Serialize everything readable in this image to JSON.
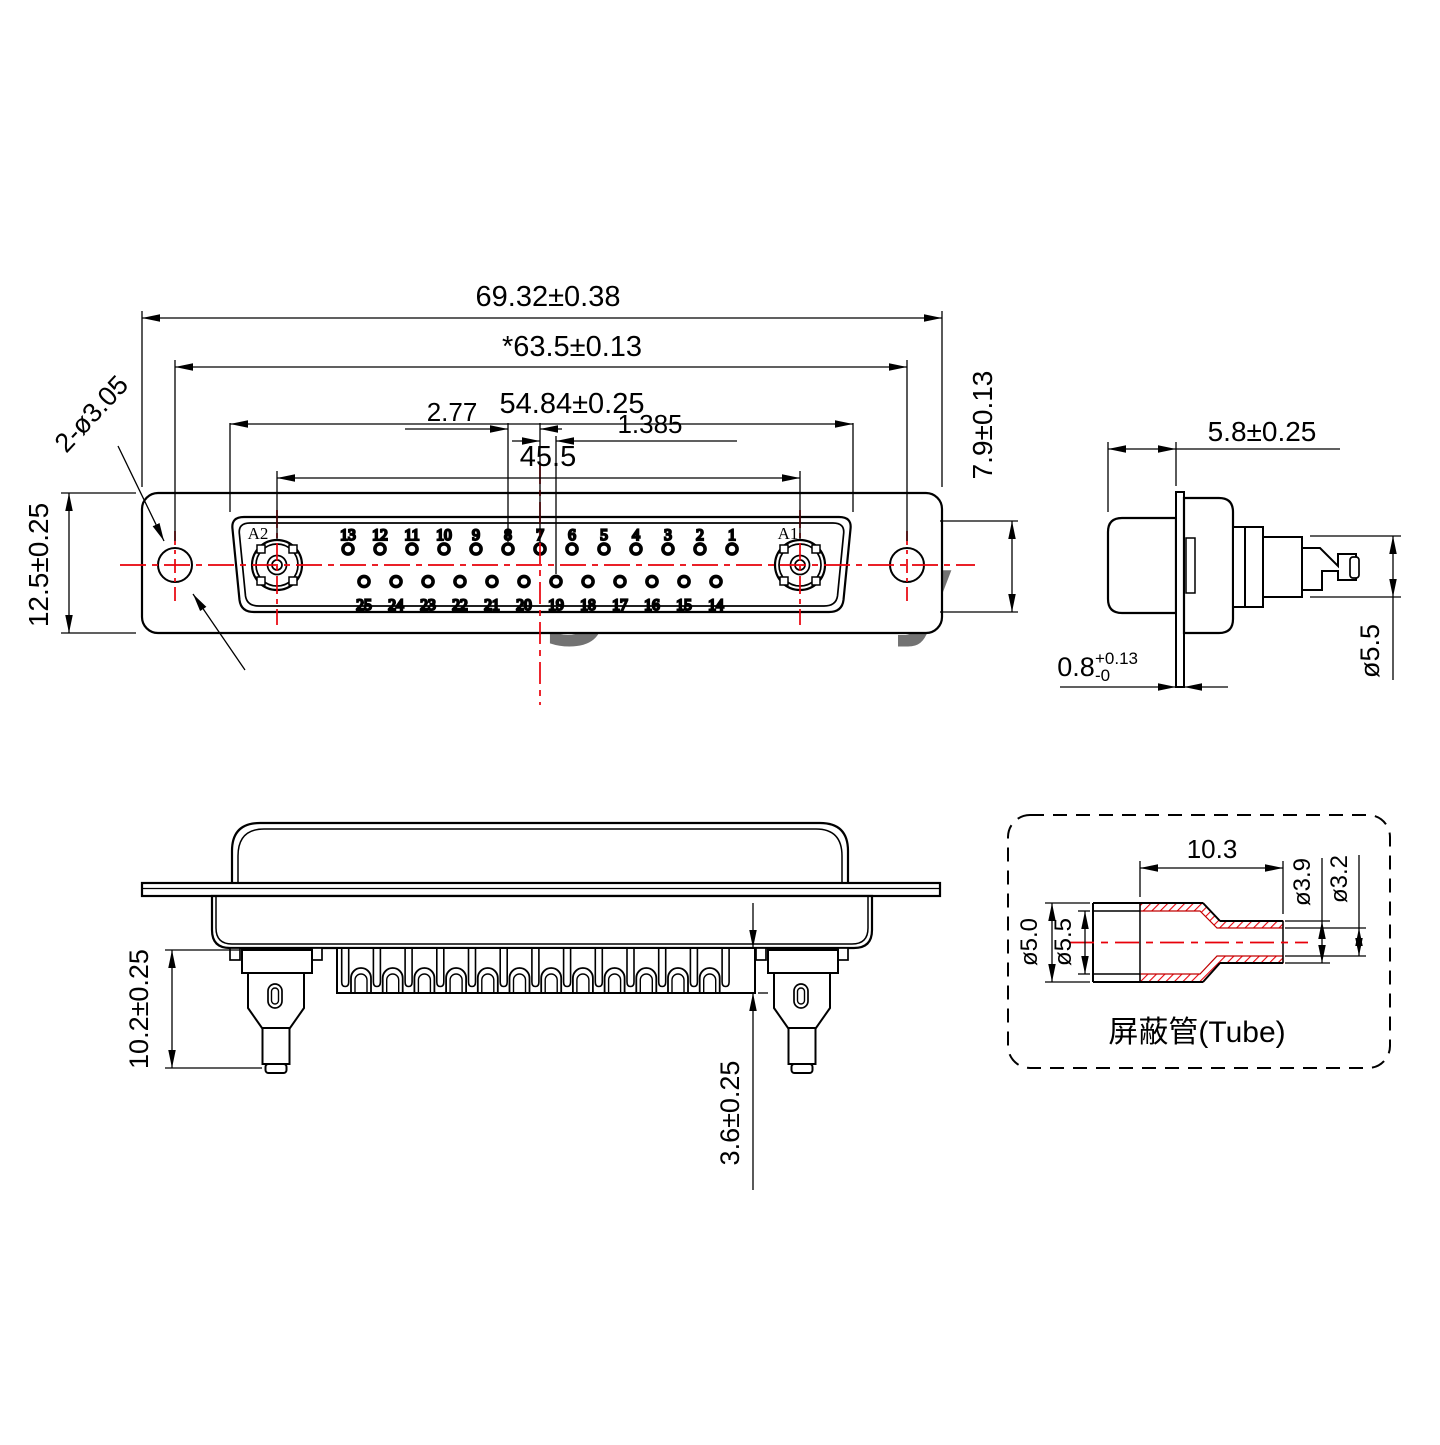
{
  "watermarks": {
    "front": "Lightany",
    "rear": "Lightany"
  },
  "front_view": {
    "dim_overall_width": "69.32±0.38",
    "dim_mount_spacing": "*63.5±0.13",
    "dim_insert_width": "54.84±0.25",
    "dim_coax_spacing": "45.5",
    "dim_pitch": "2.77",
    "dim_half_pitch": "1.385",
    "dim_height": "12.5±0.25",
    "dim_mount_hole": "2-ø3.05",
    "dim_insert_height": "7.9±0.13",
    "label_a1": "A1",
    "label_a2": "A2",
    "top_row": [
      "13",
      "12",
      "11",
      "10",
      "9",
      "8",
      "7",
      "6",
      "5",
      "4",
      "3",
      "2",
      "1"
    ],
    "bottom_row": [
      "25",
      "24",
      "23",
      "22",
      "21",
      "20",
      "19",
      "18",
      "17",
      "16",
      "15",
      "14"
    ]
  },
  "side_view": {
    "dim_shell_depth": "5.8±0.25",
    "dim_flange_thickness": "0.8",
    "dim_flange_tol_upper": "+0.13",
    "dim_flange_tol_lower": "-0",
    "dim_contact_dia": "ø5.5"
  },
  "rear_view": {
    "dim_coax_tail": "10.2±0.25",
    "dim_pin_tail": "3.6±0.25"
  },
  "tube_detail": {
    "dim_length": "10.3",
    "dim_dia_outer_small": "ø3.9",
    "dim_dia_inner_small": "ø3.2",
    "dim_dia_inner_large": "ø5.0",
    "dim_dia_outer_large": "ø5.5",
    "label": "屏蔽管(Tube)"
  },
  "colors": {
    "line": "#000000",
    "accent": "#e8000a",
    "watermark": "#f2b3b3"
  }
}
